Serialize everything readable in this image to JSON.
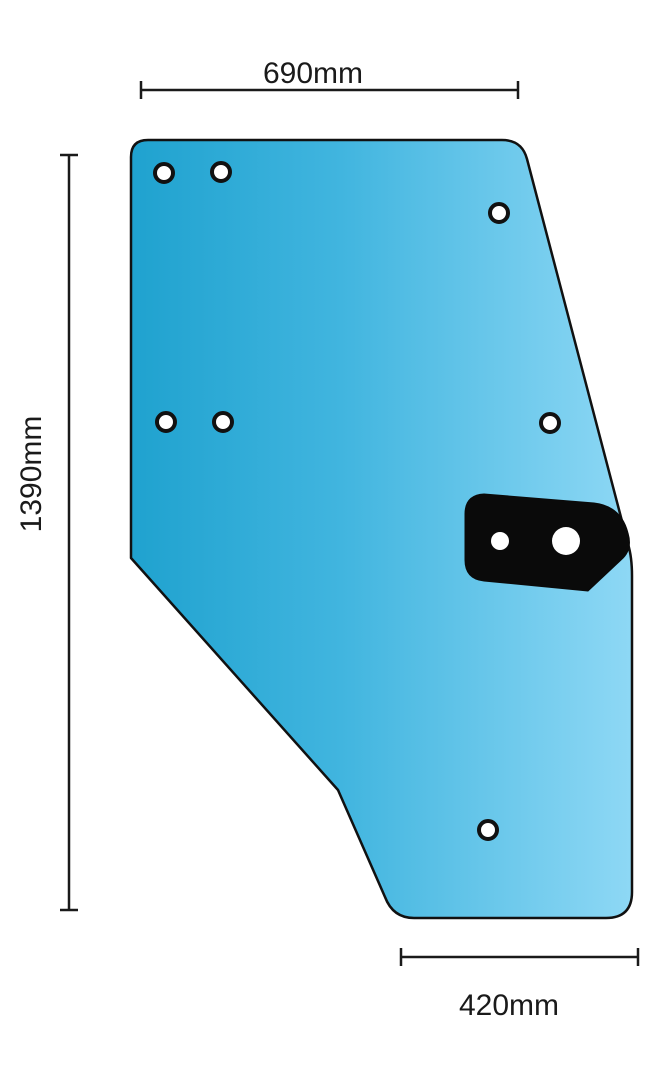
{
  "diagram": {
    "part": "door-glass-outline-drawing",
    "dimensions": {
      "top": {
        "label": "690mm"
      },
      "left": {
        "label": "1390mm"
      },
      "bottom": {
        "label": "420mm"
      }
    },
    "colors": {
      "glass_dark": "#1FA2CF",
      "glass_mid": "#41B5DF",
      "glass_light": "#8ED8F5",
      "outline": "#111111",
      "bracket": "#0a0a0a",
      "hole_fill": "#ffffff",
      "dimension": "#1a1a1a"
    },
    "mounting_holes": [
      {
        "cx": 164,
        "cy": 173,
        "r": 9
      },
      {
        "cx": 221,
        "cy": 172,
        "r": 9
      },
      {
        "cx": 499,
        "cy": 213,
        "r": 9
      },
      {
        "cx": 166,
        "cy": 422,
        "r": 9
      },
      {
        "cx": 223,
        "cy": 422,
        "r": 9
      },
      {
        "cx": 550,
        "cy": 423,
        "r": 9
      },
      {
        "cx": 488,
        "cy": 830,
        "r": 9
      }
    ],
    "bracket_holes": [
      {
        "cx": 500,
        "cy": 541,
        "r": 9
      },
      {
        "cx": 566,
        "cy": 541,
        "r": 14
      }
    ]
  }
}
